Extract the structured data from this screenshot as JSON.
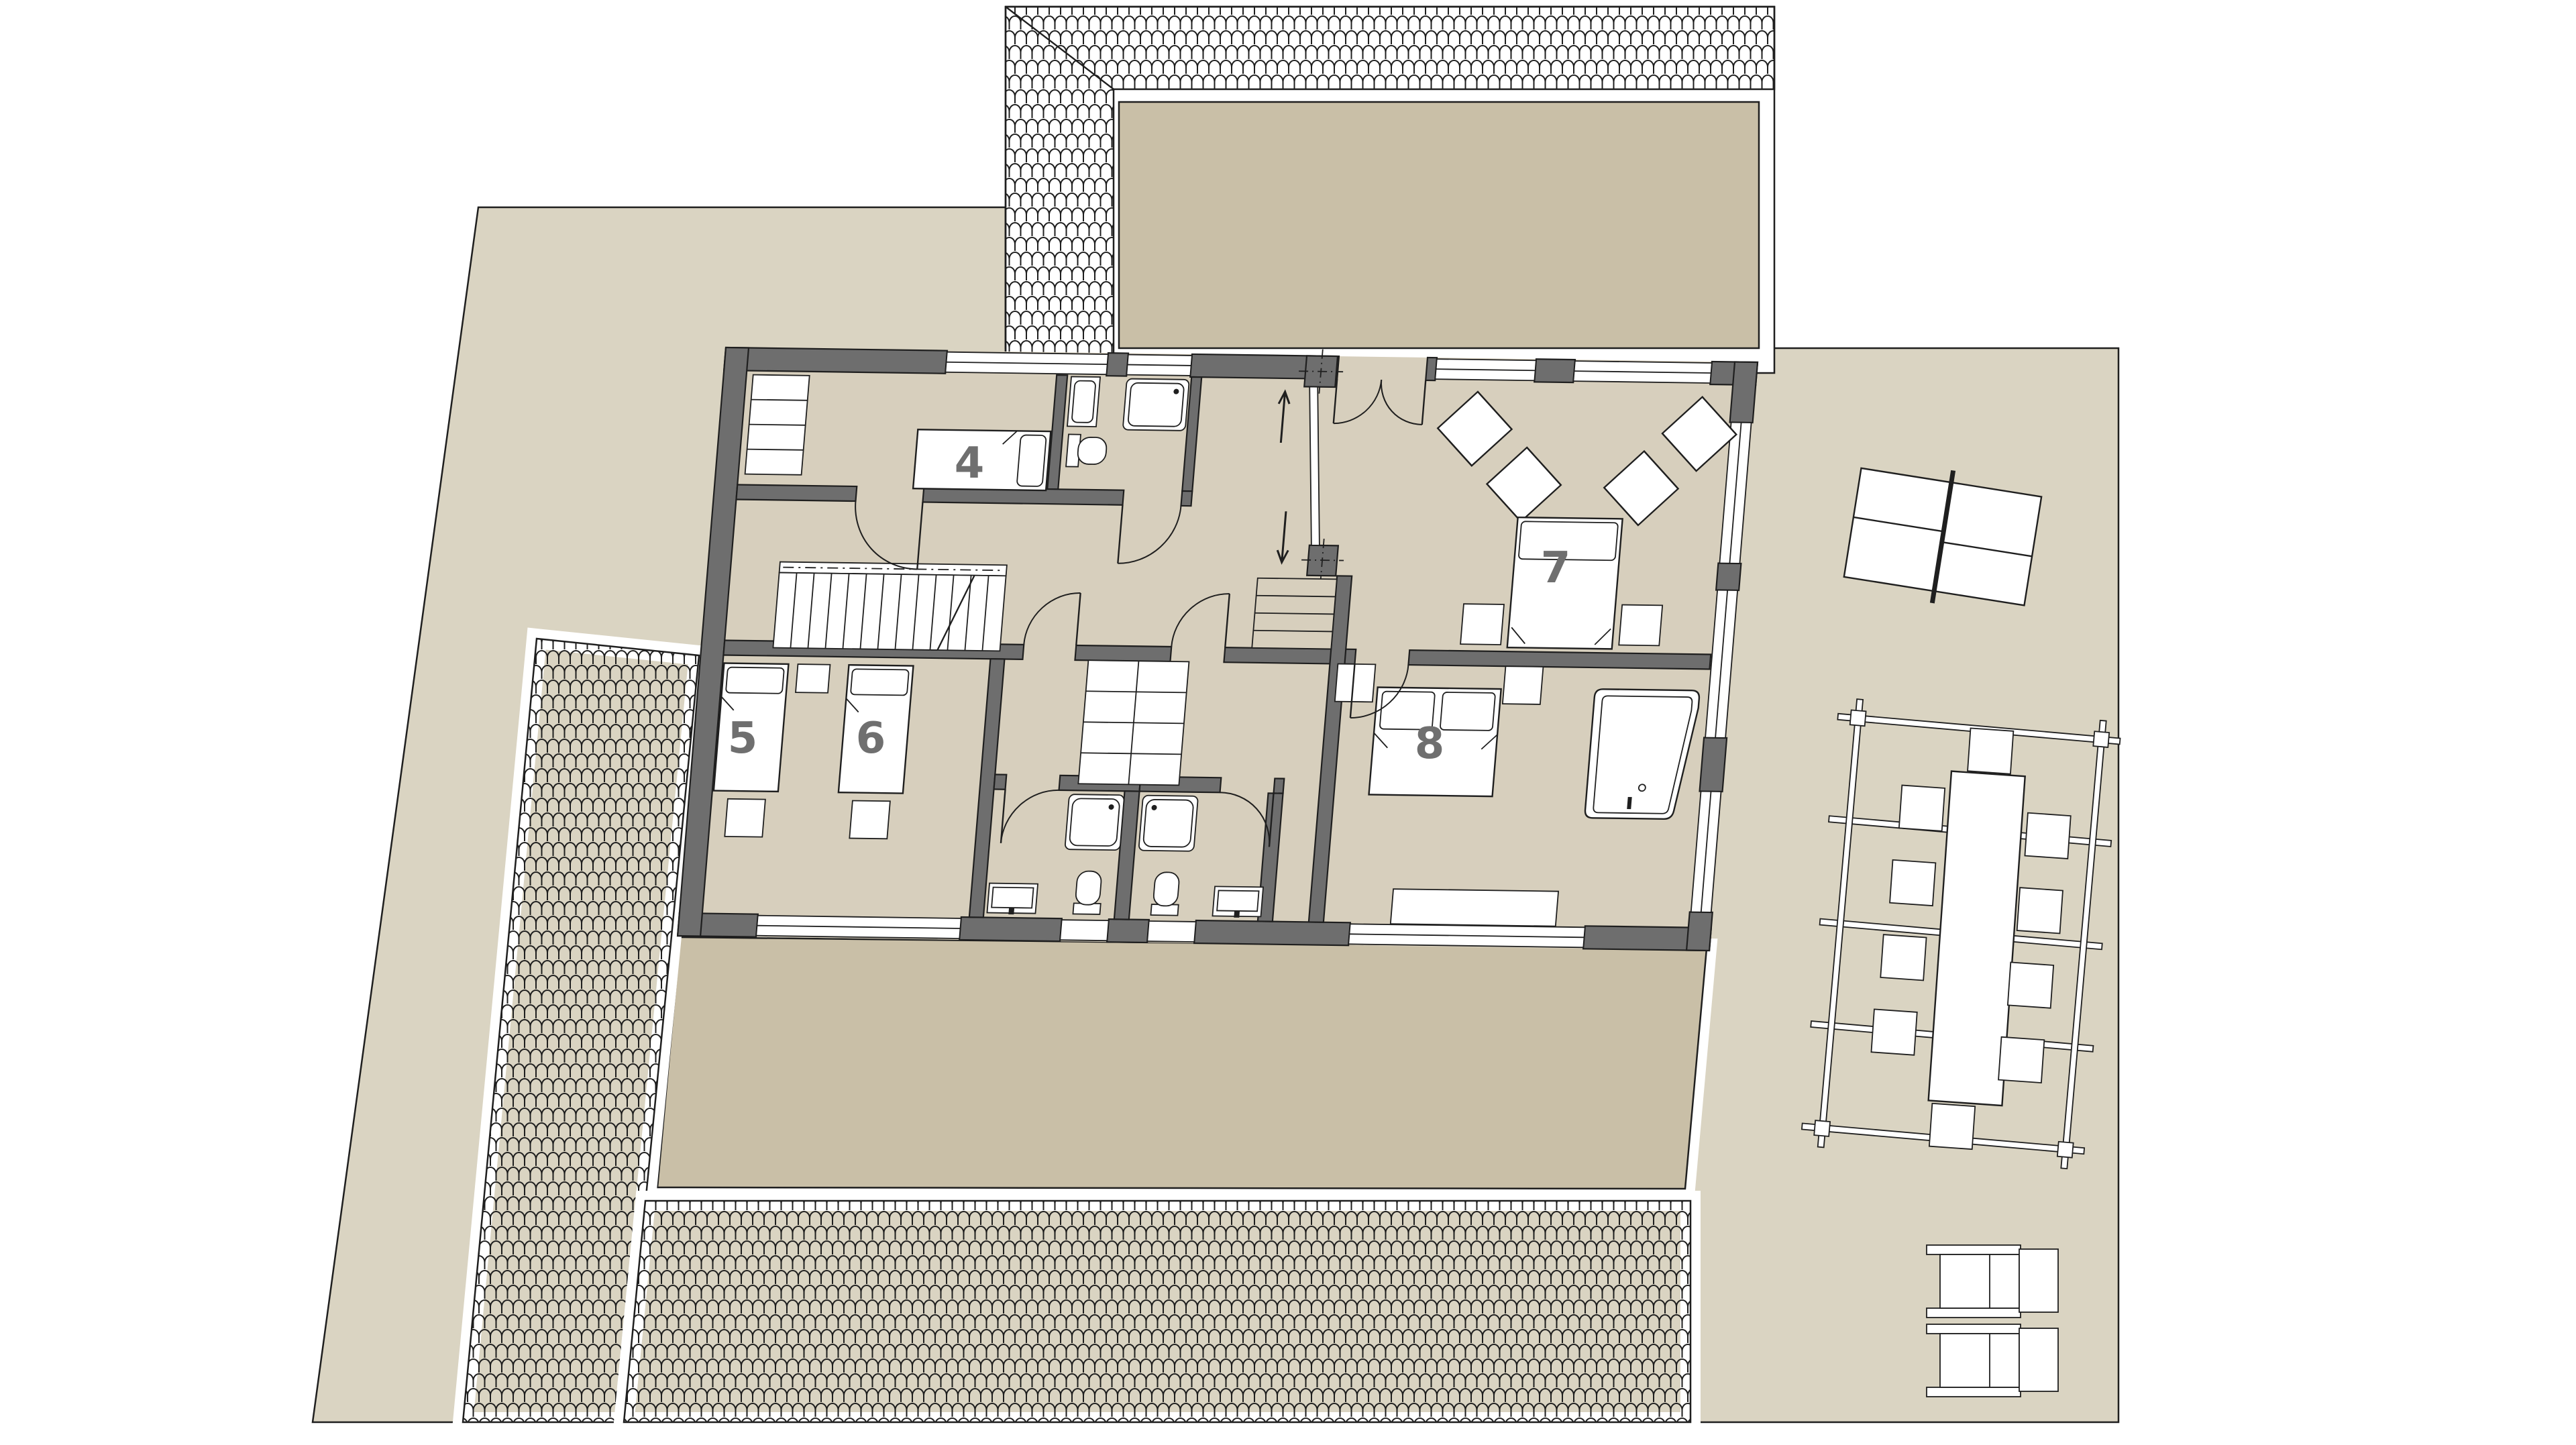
{
  "plan": {
    "type": "architectural-floor-plan",
    "rooms": [
      {
        "id": "room-4",
        "label": "4"
      },
      {
        "id": "room-5",
        "label": "5"
      },
      {
        "id": "room-6",
        "label": "6"
      },
      {
        "id": "room-7",
        "label": "7"
      },
      {
        "id": "room-8",
        "label": "8"
      }
    ],
    "stair_arrows": {
      "up": "↑",
      "down": "↓"
    }
  },
  "palette": {
    "parcel": "#dad4c2",
    "terrace": "#c9bfa7",
    "floor": "#d7cfbd",
    "wall": "#6e6e6e",
    "line": "#1f1f1f",
    "label": "#6f6f6f",
    "white": "#ffffff"
  }
}
